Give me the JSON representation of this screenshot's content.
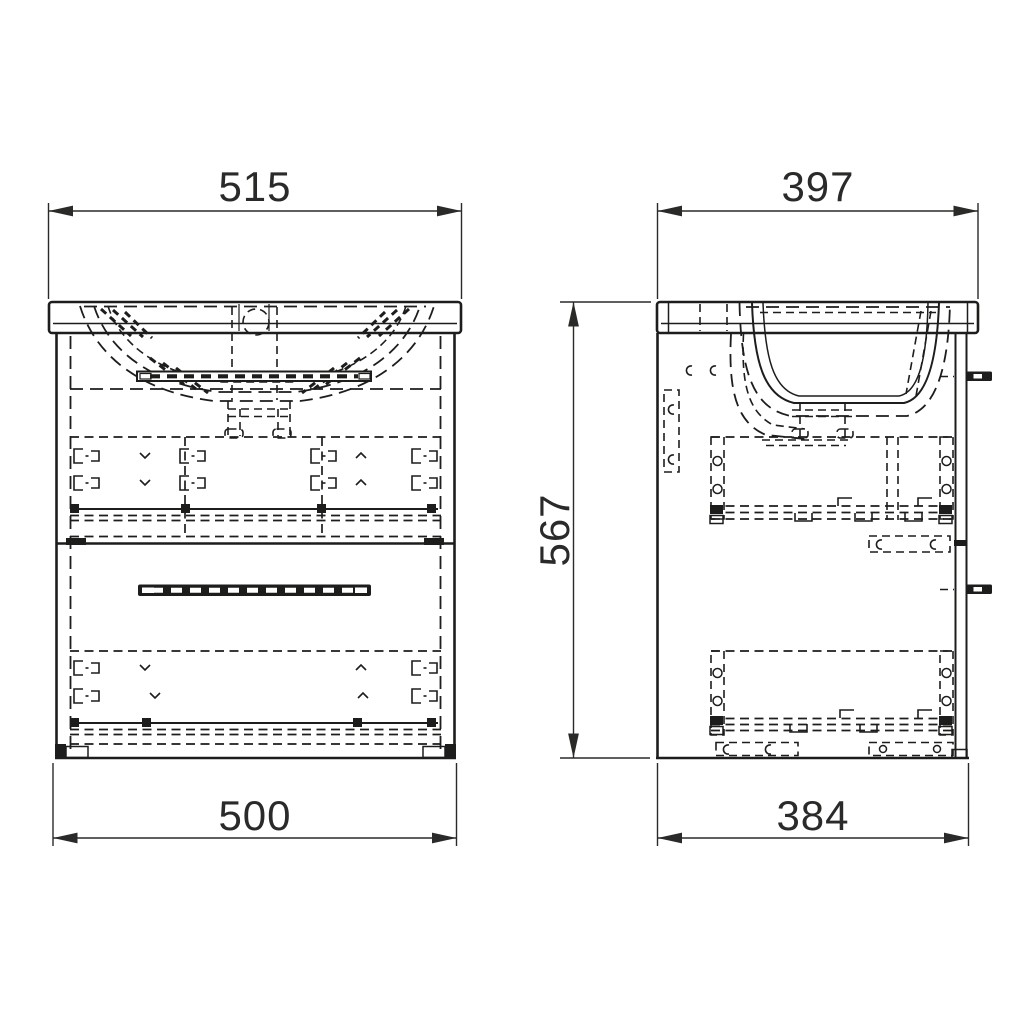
{
  "drawing": {
    "background_color": "#ffffff",
    "line_color": "#1d1d1b",
    "views": {
      "front": {
        "dim_top": "515",
        "dim_bottom": "500"
      },
      "side": {
        "dim_top": "397",
        "dim_bottom": "384",
        "dim_height": "567"
      }
    }
  }
}
